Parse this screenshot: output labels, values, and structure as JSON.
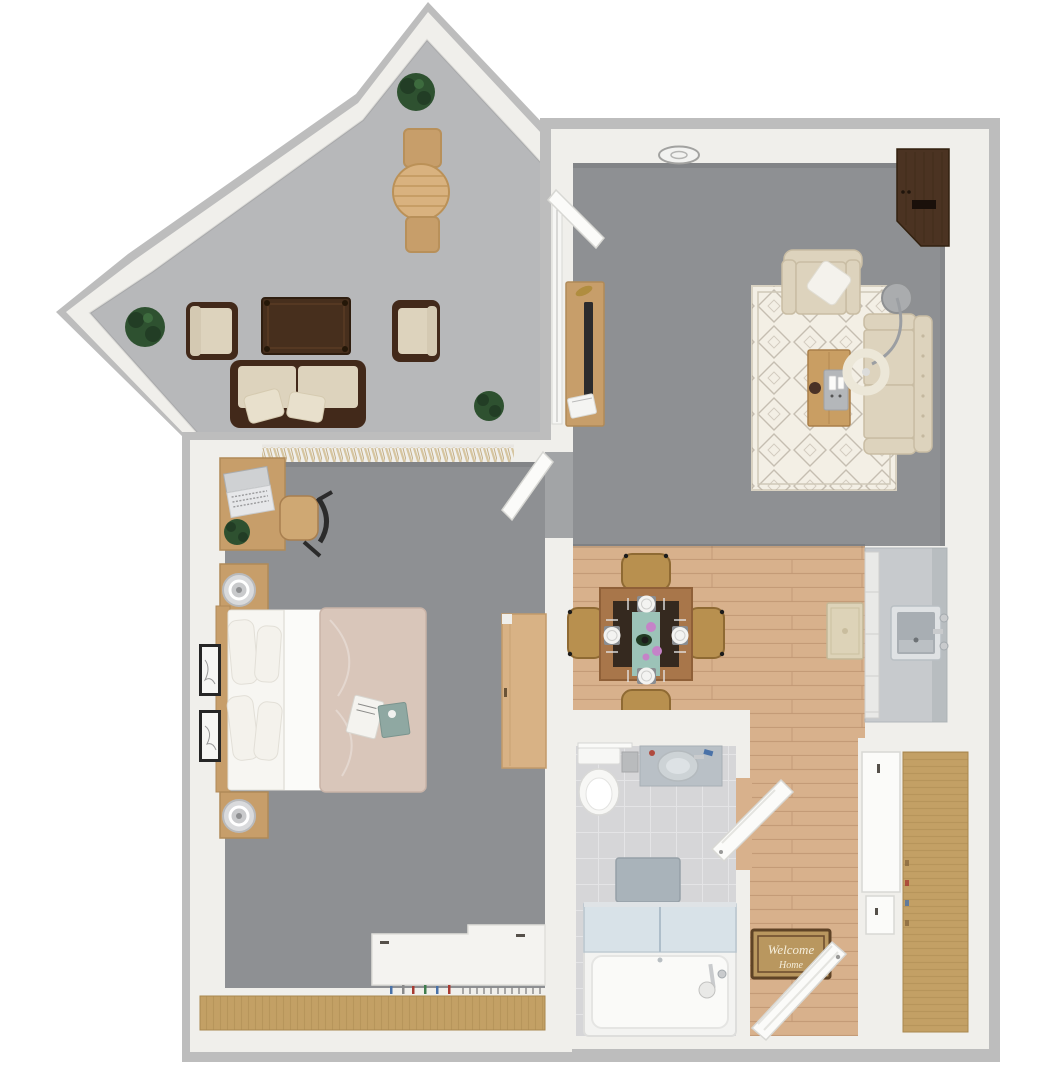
{
  "meta": {
    "type": "3D apartment floor plan, top-down view",
    "canvas": {
      "width": 1057,
      "height": 1092
    }
  },
  "welcome_mat": {
    "line1": "Welcome",
    "line2": "Home"
  },
  "colors": {
    "bg": "#ffffff",
    "wall_edge": "#bdbdbd",
    "wall": "#f0efeb",
    "balcony_floor": "#b7b8ba",
    "carpet": "#8e9093",
    "wood_floor": "#d8b18c",
    "wood_floor_line": "#c09671",
    "tile_floor": "#d6d6d8",
    "tile_line": "#e4e4e6",
    "closet_wood": "#c3a065",
    "closet_wood_line": "#a9874e",
    "rug_cream": "#f3efe5",
    "rug_pattern": "#b3aa9c",
    "sofa_beige": "#ddd3bd",
    "sofa_trim": "#c9bda4",
    "espresso": "#42291a",
    "walnut": "#4b3322",
    "pillow_white": "#f4f2ec",
    "bed_duvet": "#d9c6ba",
    "linen_white": "#f7f6f2",
    "desk_wood": "#c79e6a",
    "dresser_wood": "#d8b285",
    "rattan": "#b8904f",
    "rattan_dark": "#8f6a33",
    "table_trim": "#a8764a",
    "table_top": "#35291f",
    "runner_teal": "#9cc3b8",
    "flower_purple": "#c583c8",
    "plant_green": "#2e5130",
    "plant_dark": "#223d25",
    "stainless": "#c7cacd",
    "stainless_dark": "#a3a9ad",
    "glass_blue": "#cfdde6",
    "chrome": "#c9cbcd",
    "metal_gray": "#9b9ea2",
    "mat_tan": "#b9975f",
    "mat_border": "#5f4326",
    "mat_text": "#f5eedb",
    "tv_dark": "#2b2b2d",
    "vanity_top": "#b9c0c6",
    "bath_mat": "#a9b3ba",
    "fixture_white": "#f6f6f4",
    "door_white": "#fbfbf9",
    "door_stroke": "#d8d8d4",
    "curtain_beige": "#d6c5a0",
    "accent_gold": "#b08d3f",
    "remote_tray": "#b4b7ba",
    "lamp_shade": "#ece7d8"
  },
  "rooms": [
    {
      "id": "balcony",
      "label": "Balcony / Patio",
      "floor": "concrete"
    },
    {
      "id": "living-room",
      "label": "Living Room",
      "floor": "gray carpet"
    },
    {
      "id": "dining-area",
      "label": "Dining Area",
      "floor": "wood plank"
    },
    {
      "id": "kitchen",
      "label": "Kitchen",
      "floor": "wood plank"
    },
    {
      "id": "bedroom",
      "label": "Bedroom",
      "floor": "gray carpet"
    },
    {
      "id": "bathroom",
      "label": "Bathroom",
      "floor": "tile"
    },
    {
      "id": "entry",
      "label": "Entry Hall",
      "floor": "wood plank"
    }
  ],
  "furniture": {
    "balcony": [
      "round bistro table",
      "2 bistro chairs",
      "3 potted plants",
      "2 wicker armchairs",
      "wicker loveseat",
      "outdoor coffee table"
    ],
    "living_room": [
      "media console with TV",
      "ceiling light",
      "wood storage cabinet",
      "armchair with throw pillow",
      "tufted loveseat",
      "moroccan area rug",
      "coffee table with remote tray",
      "arc floor lamp",
      "balcony door"
    ],
    "dining_area": [
      "square dining table",
      "4 rattan chairs",
      "4 place settings",
      "teal table runner with flowers"
    ],
    "kitchen": [
      "stainless counter with sink",
      "cabinet drawers",
      "runner rug"
    ],
    "bedroom": [
      "desk with laptop",
      "desk chair",
      "potted plant",
      "bed with 4 pillows",
      "2 nightstands with lamps",
      "2 framed artworks",
      "tall dresser",
      "low white cabinet",
      "closet with hangers",
      "window curtain",
      "bedroom door"
    ],
    "bathroom": [
      "toilet",
      "vanity sink",
      "towel bar",
      "bath mat",
      "tub with glass shower doors",
      "bathroom door"
    ],
    "entry": [
      "welcome mat",
      "front door",
      "double closet doors"
    ]
  }
}
